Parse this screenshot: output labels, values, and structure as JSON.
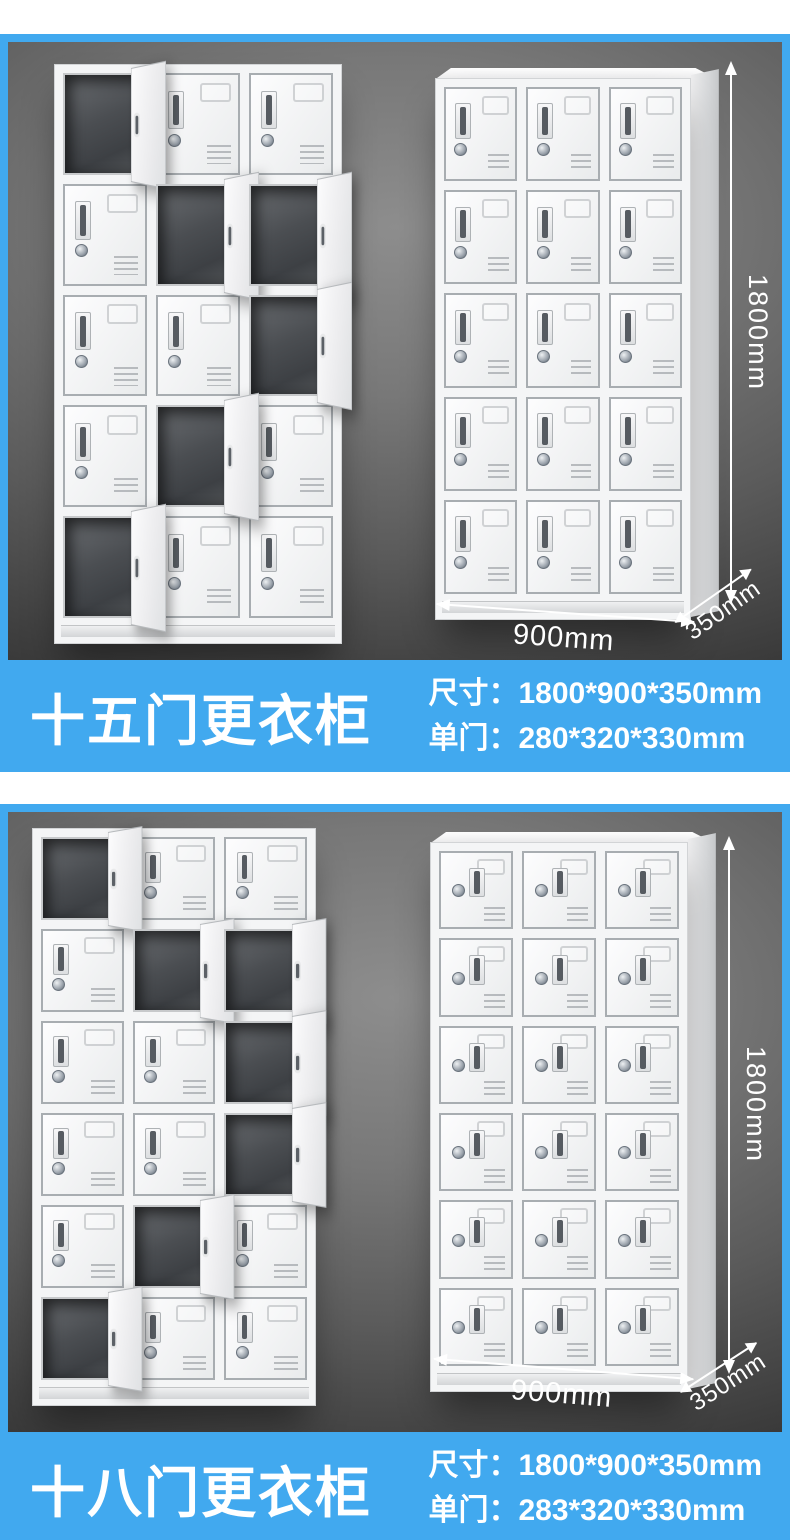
{
  "theme": {
    "accent_blue": "#41a9ef",
    "photo_background": "#5b5b5b",
    "text_white": "#ffffff"
  },
  "sections": [
    {
      "title": "十五门更衣柜",
      "specs": [
        {
          "label": "尺寸：",
          "value": "1800*900*350mm"
        },
        {
          "label": "单门：",
          "value": "280*320*330mm"
        }
      ],
      "dims": {
        "height": "1800mm",
        "width": "900mm",
        "depth": "350mm"
      }
    },
    {
      "title": "十八门更衣柜",
      "specs": [
        {
          "label": "尺寸：",
          "value": "1800*900*350mm"
        },
        {
          "label": "单门：",
          "value": "283*320*330mm"
        }
      ],
      "dims": {
        "height": "1800mm",
        "width": "900mm",
        "depth": "350mm"
      }
    }
  ],
  "lockers": {
    "s1_left": {
      "rows": 5,
      "cols": 3,
      "style": "left",
      "open": [
        [
          0,
          0
        ],
        [
          1,
          1
        ],
        [
          1,
          2
        ],
        [
          2,
          2
        ],
        [
          3,
          1
        ],
        [
          4,
          0
        ]
      ]
    },
    "s1_right": {
      "rows": 5,
      "cols": 3,
      "style": "left",
      "open": []
    },
    "s2_left": {
      "rows": 6,
      "cols": 3,
      "style": "left",
      "open": [
        [
          0,
          0
        ],
        [
          1,
          1
        ],
        [
          1,
          2
        ],
        [
          2,
          2
        ],
        [
          3,
          2
        ],
        [
          4,
          1
        ],
        [
          5,
          0
        ]
      ]
    },
    "s2_right": {
      "rows": 6,
      "cols": 3,
      "style": "center",
      "open": []
    }
  }
}
